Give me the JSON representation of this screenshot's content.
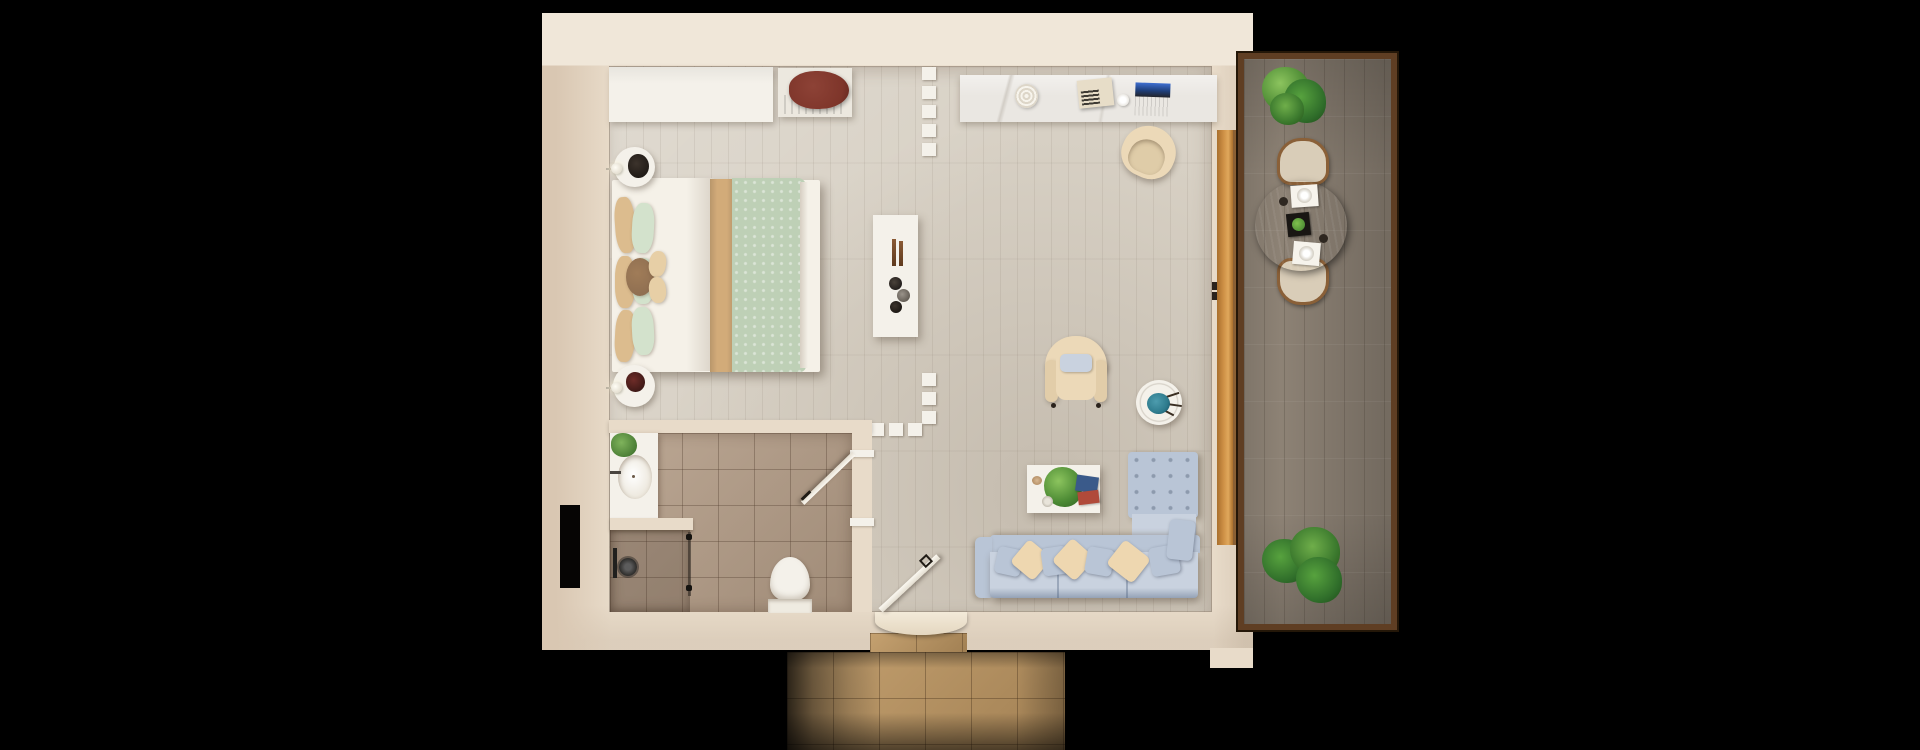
{
  "scene": {
    "kind": "apartment floor plan, top-down 3d render",
    "rooms": [
      {
        "name": "bedroom",
        "furniture": [
          "wardrobe",
          "luggage-bench",
          "double-bed",
          "nightstand-top",
          "nightstand-bottom",
          "wall-lamps"
        ]
      },
      {
        "name": "bathroom",
        "furniture": [
          "vanity-sink",
          "shower",
          "toilet",
          "bathroom-door"
        ]
      },
      {
        "name": "living-area",
        "furniture": [
          "console-table",
          "armchair",
          "flower-side-table",
          "coffee-table",
          "l-shaped-sofa"
        ]
      },
      {
        "name": "desk-nook",
        "furniture": [
          "desk-counter",
          "woven-basket",
          "radio-device",
          "cup",
          "laptop",
          "desk-chair"
        ]
      },
      {
        "name": "balcony",
        "furniture": [
          "potted-plant-top",
          "dining-table",
          "dining-chair-north",
          "dining-chair-south",
          "potted-plants-bottom"
        ]
      },
      {
        "name": "entry",
        "furniture": [
          "entry-door",
          "threshold-step",
          "stone-path"
        ]
      }
    ],
    "markers": [
      "partition-dash-line-top",
      "partition-dash-line-corner",
      "wall-niche-black"
    ]
  },
  "palette": {
    "bg": "#000000",
    "wall": "#e8dbc9",
    "wallLight": "#f0e7d9",
    "wallShade": "#d9c7b2",
    "floor": "#d8d1c5",
    "tile": "#b29b85",
    "white": "#f4f1ea",
    "offWhite": "#ece8df",
    "marble": "#eae7e2",
    "bedWhite": "#f5f1e8",
    "blanketRed": "#7e352a",
    "bedTan": "#d2ab79",
    "bedGreen": "#bed0b6",
    "pillowTan": "#dcbc8e",
    "pillowGreen": "#d3e2cc",
    "cushionBrown": "#8a6b4f",
    "sofaBlue": "#b9c5d6",
    "sofaBlueLight": "#c9d2df",
    "pillowCream": "#eed7b0",
    "armCream": "#ecd9b8",
    "teal": "#2e7b8d",
    "woodOrange": "#cd8f45",
    "woodDark": "#5f3e23",
    "deck": "#8d8275",
    "tableWood": "#9c7143",
    "chairSand": "#d9cdb8",
    "stone": "#b8925f",
    "screenBlue": "#3f6fd0"
  }
}
